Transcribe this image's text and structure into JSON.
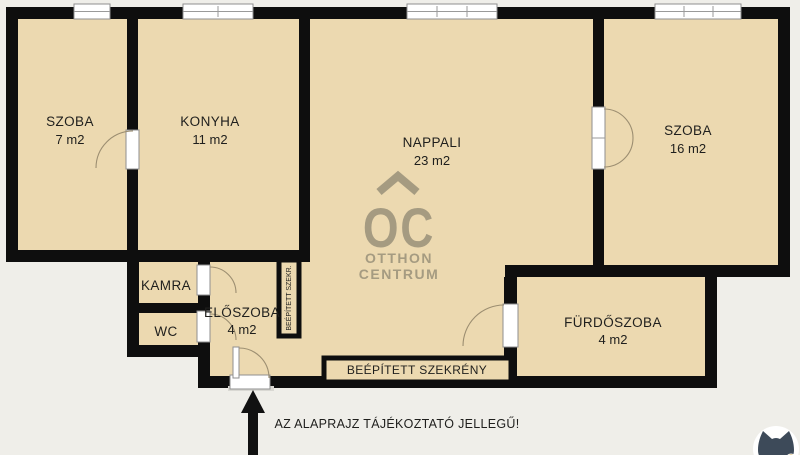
{
  "plan": {
    "rooms": {
      "szoba7": {
        "name": "SZOBA",
        "area": "7 m2"
      },
      "konyha": {
        "name": "KONYHA",
        "area": "11 m2"
      },
      "nappali": {
        "name": "NAPPALI",
        "area": "23 m2"
      },
      "szoba16": {
        "name": "SZOBA",
        "area": "16 m2"
      },
      "kamra": {
        "name": "KAMRA"
      },
      "wc": {
        "name": "WC"
      },
      "eloszoba": {
        "name": "ELŐSZOBA",
        "area": "4 m2"
      },
      "furdoszoba": {
        "name": "FÜRDŐSZOBA",
        "area": "4 m2"
      }
    },
    "closets": {
      "bottom_wardrobe": {
        "label": "BEÉPÍTETT SZEKRÉNY"
      },
      "vertical_wardrobe": {
        "label": "BEÉPÍTETT SZEKR."
      }
    },
    "branding": {
      "monogram": "OC",
      "line1": "OTTHON",
      "line2": "CENTRUM"
    },
    "footer": {
      "disclaimer": "AZ ALAPRAJZ TÁJÉKOZTATÓ JELLEGŰ!"
    },
    "icons": {
      "entrance": "entrance-arrow-icon",
      "watermark": "cat-logo-icon",
      "logo_roof": "roof-icon"
    },
    "colors": {
      "background": "#efeee9",
      "floor": "#ecd9b0",
      "wall": "#0e0e0e",
      "logo": "#a59b81",
      "text": "#1f1f1d",
      "door_arc": "#9c8e71",
      "cat": "#3d4a59",
      "cat_badge": "#d2a53f"
    }
  }
}
